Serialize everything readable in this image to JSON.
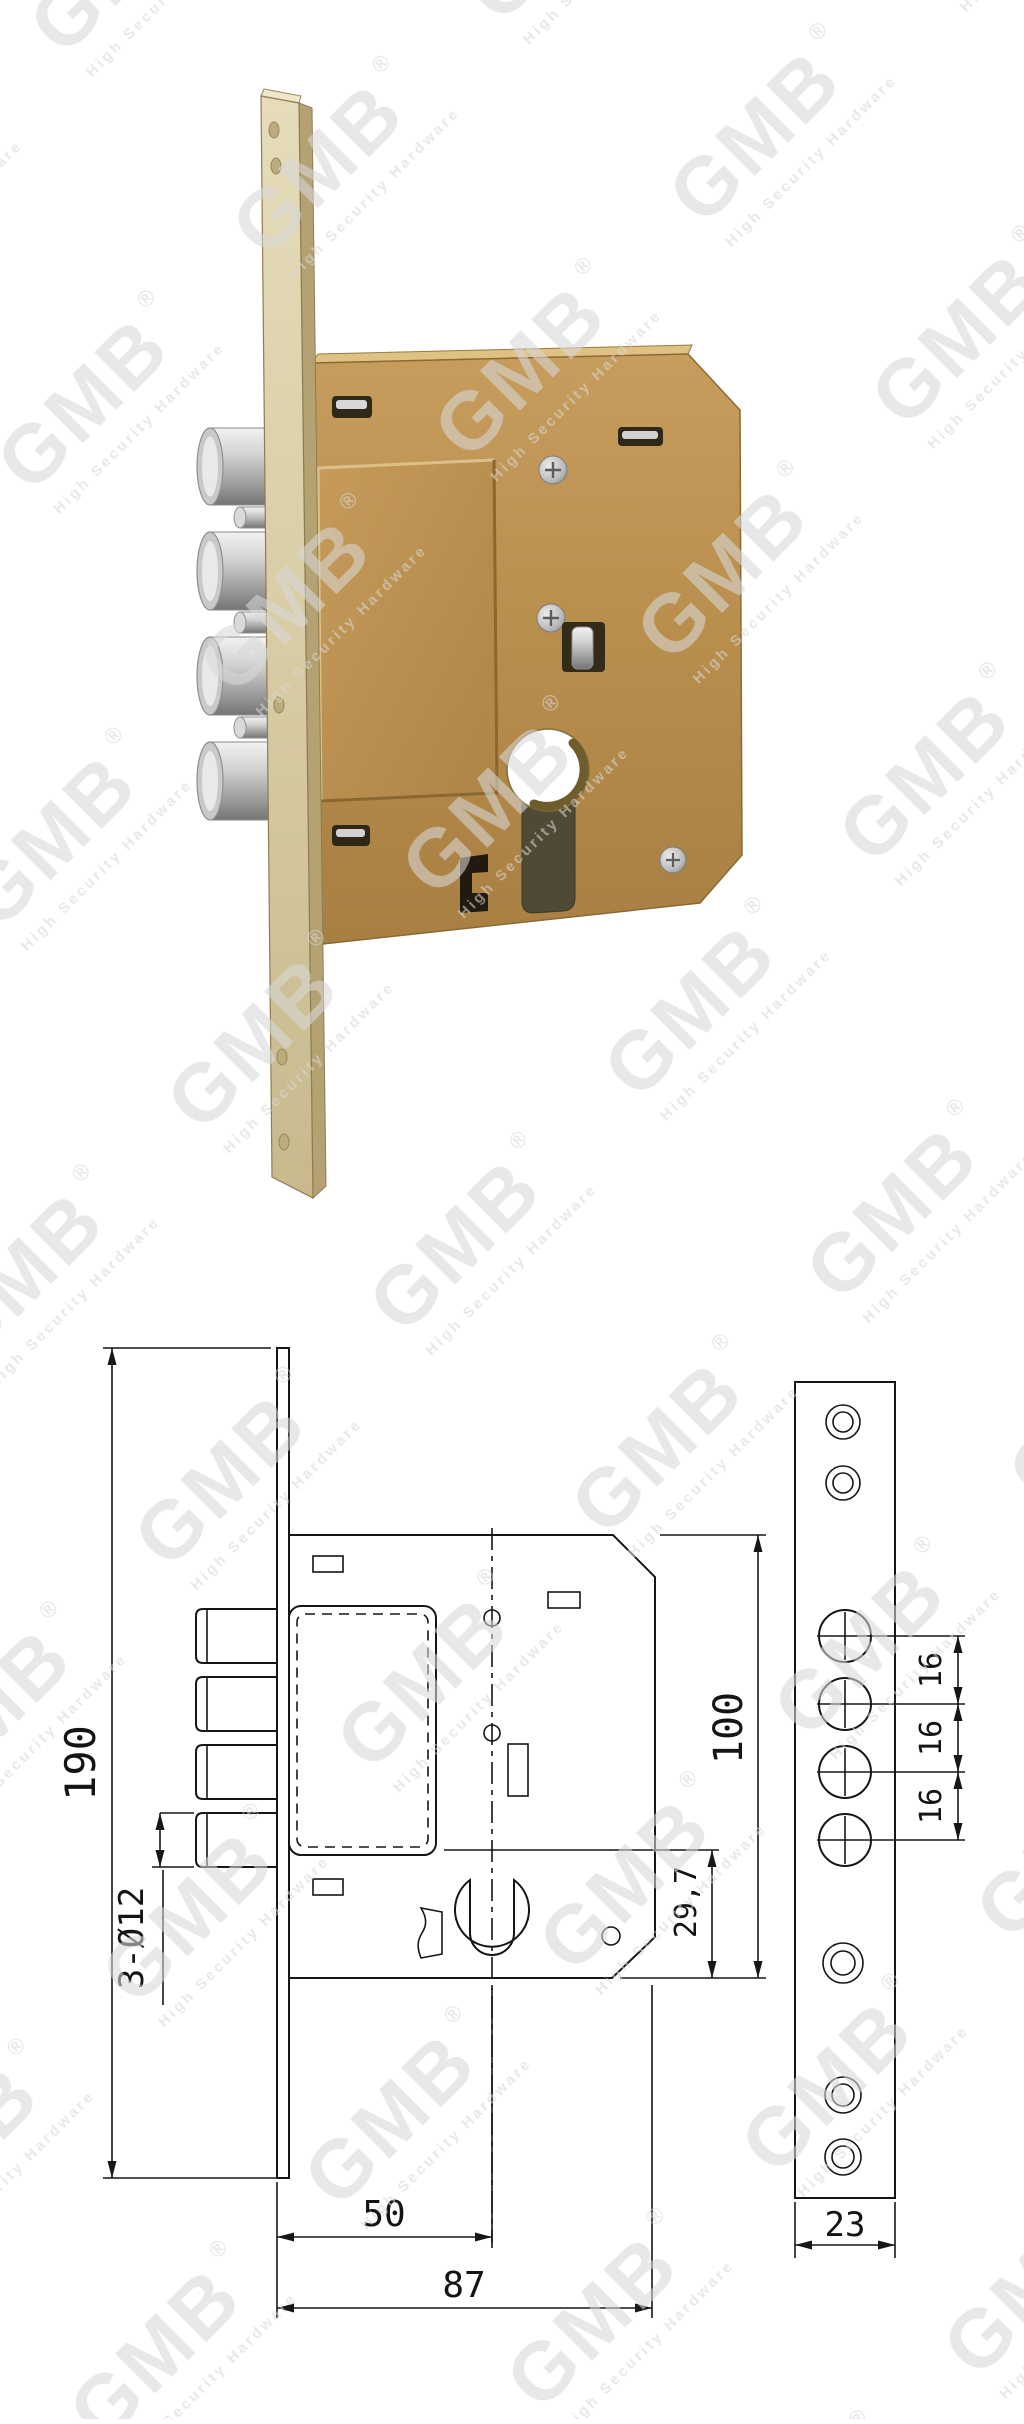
{
  "watermark": {
    "brand": "GMB",
    "registered": "®",
    "tagline": "High Security Hardware"
  },
  "drawing": {
    "dim_faceplate_height": "190",
    "dim_bolt_diameter": "3-Ø12",
    "dim_backset": "50",
    "dim_case_depth": "87",
    "dim_case_height": "100",
    "dim_cylinder_to_bottom": "29,7",
    "dim_bolt_spacing": [
      "16",
      "16",
      "16"
    ],
    "dim_bar_width": "23"
  }
}
